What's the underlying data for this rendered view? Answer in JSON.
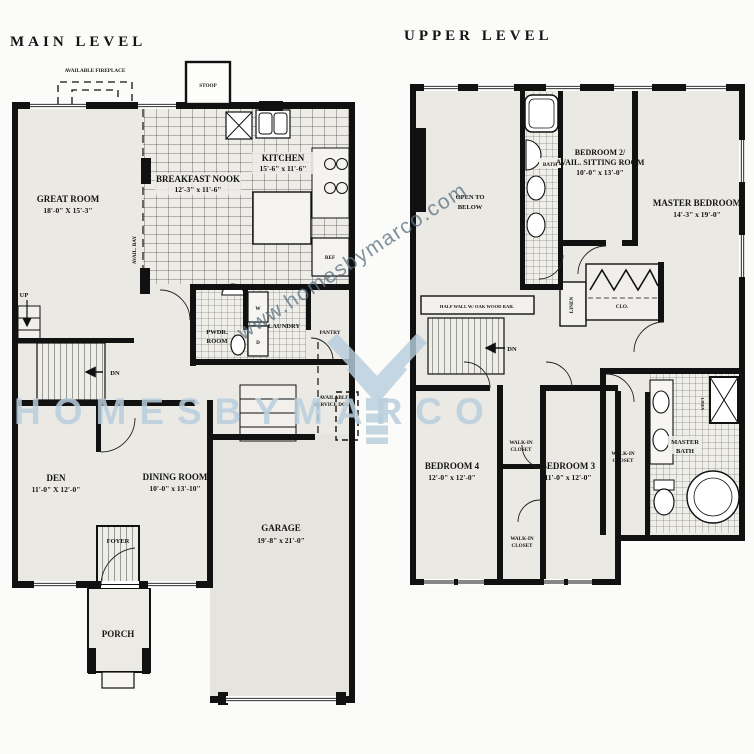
{
  "watermark": {
    "url": "www.homesbymarco.com",
    "brand": "HOMESBYMARCO",
    "accent_color": "#b9cedd"
  },
  "main_level": {
    "title": "MAIN LEVEL",
    "fireplace": "AVAILABLE FIREPLACE",
    "stoop": "STOOP",
    "great_room": "GREAT ROOM",
    "great_room_dims": "18'-0\" X 15'-3\"",
    "breakfast": "BREAKFAST NOOK",
    "breakfast_dims": "12'-3\" x 11'-6\"",
    "kitchen": "KITCHEN",
    "kitchen_dims": "15'-6\" x 11'-6\"",
    "dw": "DW",
    "ref": "REF",
    "avail_bay": "AVAIL. BAY",
    "pwdr1": "PWDR.",
    "pwdr2": "ROOM",
    "laundry": "LAUNDRY",
    "w": "W",
    "d": "D",
    "pantry": "PANTRY",
    "up": "UP",
    "dn": "DN",
    "service1": "AVAILABLE",
    "service2": "SERVICE DOOR",
    "den": "DEN",
    "den_dims": "11'-0\" X 12'-0\"",
    "dining": "DINING ROOM",
    "dining_dims": "10'-0\" x 13'-10\"",
    "foyer": "FOYER",
    "garage": "GARAGE",
    "garage_dims": "19'-8\" x 21'-0\"",
    "porch": "PORCH"
  },
  "upper_level": {
    "title": "UPPER LEVEL",
    "open1": "OPEN TO",
    "open2": "BELOW",
    "bath": "BATH",
    "bedroom2_line1": "BEDROOM 2/",
    "bedroom2_line2": "AVAIL. SITTING ROOM",
    "bedroom2_dims": "10'-0\" x 13'-0\"",
    "master_bedroom": "MASTER BEDROOM",
    "master_bedroom_dims": "14'-3\" x 19'-0\"",
    "half_wall": "HALF WALL W/ OAK WOOD RAIL",
    "dn": "DN",
    "linen": "LINEN",
    "clo": "CLO.",
    "bedroom4": "BEDROOM 4",
    "bedroom4_dims": "12'-0\" x 12'-0\"",
    "bedroom3": "BEDROOM 3",
    "bedroom3_dims": "11'-0\" x 12'-0\"",
    "wic1": "WALK-IN",
    "wic2": "CLOSET",
    "master_bath1": "MASTER",
    "master_bath2": "BATH"
  }
}
